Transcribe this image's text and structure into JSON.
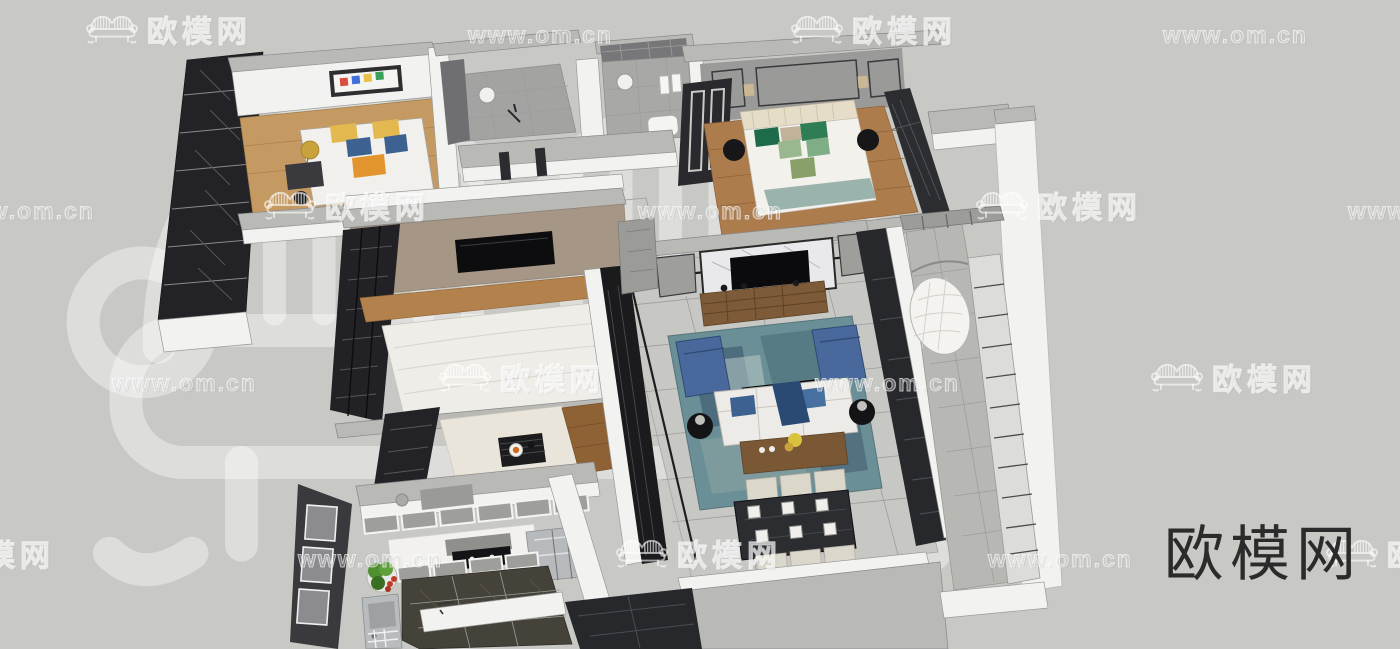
{
  "brand": {
    "logo_text": "欧模网"
  },
  "watermark": {
    "logo_text": "欧模网",
    "url_text": "www.om.cn"
  },
  "palette": {
    "background": "#c8c8c5",
    "logo_dark": "#2b2b2b",
    "wall_white": "#f2f2f0",
    "wall_top_gray": "#b9b9b6",
    "wood_light": "#c59a62",
    "wood_mid": "#ad7c4c",
    "wood_dark": "#8f6236",
    "taupe_panel": "#a69685",
    "tile_gray": "#c7c7c4",
    "dark_cabinet": "#232327",
    "marble_dark": "#2b2d31",
    "rug_teal": "#6b8f96",
    "chair_blue": "#49699c",
    "pillow_blue": "#3d6291",
    "sofa_white": "#edebe7",
    "chair_cream": "#dcd7cb",
    "veg_green": "#4f8f2f",
    "tomato_red": "#c23b2a",
    "steel": "#b7babc",
    "accent_gold": "#c9a23c",
    "green_pillow": "#1e6b4a"
  },
  "scene": {
    "type": "3d-floorplan-render",
    "objects": [
      "bookshelf",
      "guest-bed",
      "desk",
      "floor-lamp",
      "shower-room",
      "toilet",
      "master-bed",
      "nightstands",
      "wardrobe",
      "tv-panel",
      "platform-bed",
      "tea-table",
      "tv-wall",
      "tv-console",
      "area-rug",
      "armchairs",
      "coffee-table",
      "sofa",
      "console-table",
      "dining-table",
      "dining-chairs",
      "hanging-egg-chair",
      "balcony-railing",
      "kitchen-counter",
      "cooktop",
      "range-hood",
      "fridge",
      "vegetable-bowl",
      "sink",
      "entry-marble-floor"
    ]
  }
}
